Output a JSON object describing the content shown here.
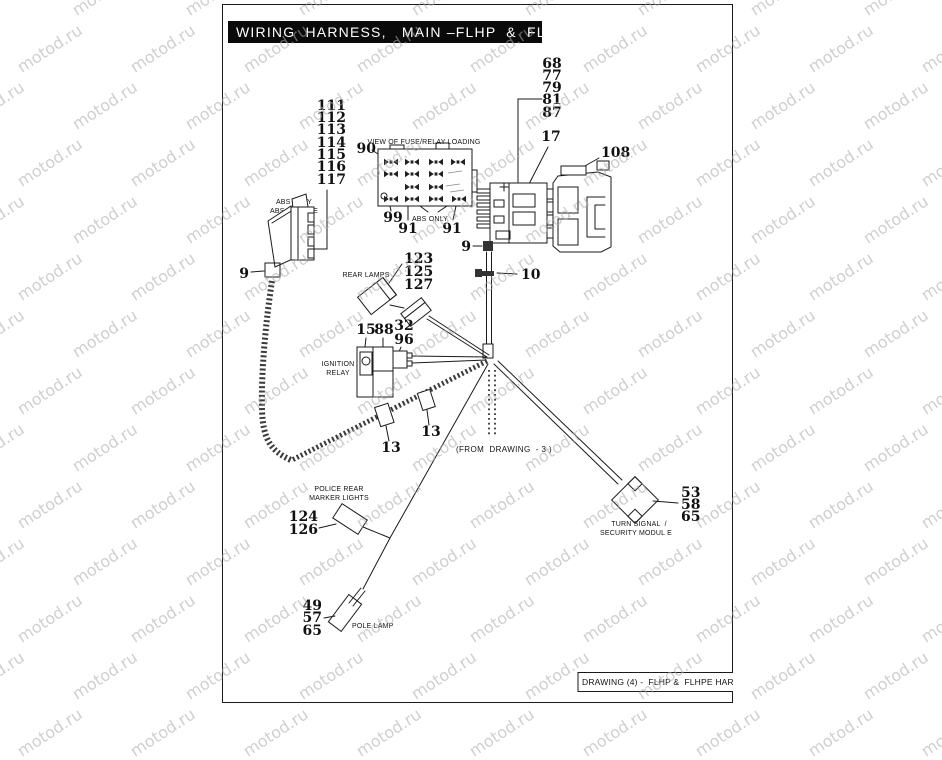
{
  "page": {
    "title": "WIRING  HARNESS,   MAIN –FLHP  &  FLHPE",
    "footer": "DRAWING (4) -  FLHP &  FLHPE HARNES",
    "watermark": "motod.ru",
    "line_color": "#1a1a1a",
    "titlebar_color": "#0a0a0a"
  },
  "labels": {
    "fuse_view": "VIEW OF FUSE/RELAY LOADING",
    "abs_only": "ABS ONLY",
    "abs_module": "ABS MODULE",
    "abs_only_fuse": "ABS ONLY",
    "rear_lamps": "REAR LAMPS",
    "ignition": "IGNITION",
    "relay": "RELAY",
    "from_drawing": "(FROM  DRAWING  - 3 )",
    "police_line1": "POLICE REAR",
    "police_line2": "MARKER LIGHTS",
    "pole_lamp": "POLE LAMP",
    "turn_line1": "TURN SIGNAL  /",
    "turn_line2": "SECURITY MODUL E"
  },
  "callouts": {
    "harness": [
      "111",
      "112",
      "113",
      "114",
      "115",
      "116",
      "117"
    ],
    "connector_stack": [
      "68",
      "77",
      "79",
      "81",
      "87"
    ],
    "n17": "17",
    "n108": "108",
    "n90": "90",
    "n99": "99",
    "n91a": "91",
    "n91b": "91",
    "n9_module": "9",
    "n9_wire": "9",
    "n10": "10",
    "rear_lamps": [
      "123",
      "125",
      "127"
    ],
    "n15": "15",
    "n88": "88",
    "n32": "32",
    "n96": "96",
    "n13a": "13",
    "n13b": "13",
    "police": [
      "124",
      "126"
    ],
    "pole": [
      "49",
      "57",
      "65"
    ],
    "turn": [
      "53",
      "58",
      "65"
    ]
  }
}
